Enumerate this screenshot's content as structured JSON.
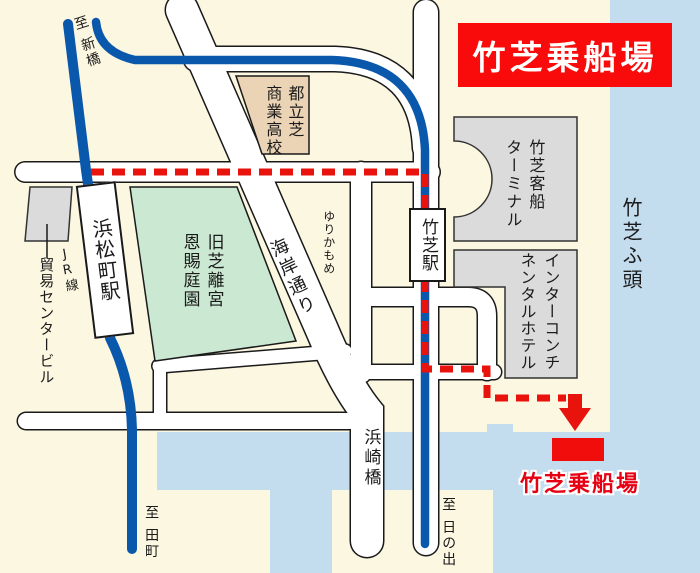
{
  "map": {
    "banner_title": "竹芝乗船場",
    "destination_label": "竹芝乗船場",
    "directions": {
      "shimbashi": "至 新橋",
      "tamachi": "至 田町",
      "hinode": "至 日の出"
    },
    "railways": {
      "jr": "JR線",
      "yurikamome": "ゆりかもめ"
    },
    "stations": {
      "hamamatsucho": "浜松町駅",
      "takeshiba": "竹芝駅"
    },
    "landmarks": {
      "school_col_right": "都立芝",
      "school_col_left": "商業高校",
      "park_col_right": "旧芝離宮",
      "park_col_left": "恩賜庭園",
      "terminal_col_right": "竹芝客船",
      "terminal_col_left": "ターミナル",
      "hotel_col_right": "インターコンチ",
      "hotel_col_left": "ネンタルホテル",
      "trade_center": "貿易センタービル",
      "pier_area": "竹芝ふ頭",
      "bridge": "浜崎橋",
      "street": "海岸通り"
    },
    "colors": {
      "background": "#FBF7E1",
      "water": "#C4DDEE",
      "road_fill": "#FFFFFF",
      "road_casing": "#1A1A1A",
      "park_green": "#CBE8D2",
      "school_tan": "#EBD3B6",
      "building_gray": "#DBDBDB",
      "rail_blue": "#0A58AB",
      "route_red": "#E8130D",
      "banner_red": "#F90B0B",
      "destination_red": "#E60012"
    }
  }
}
